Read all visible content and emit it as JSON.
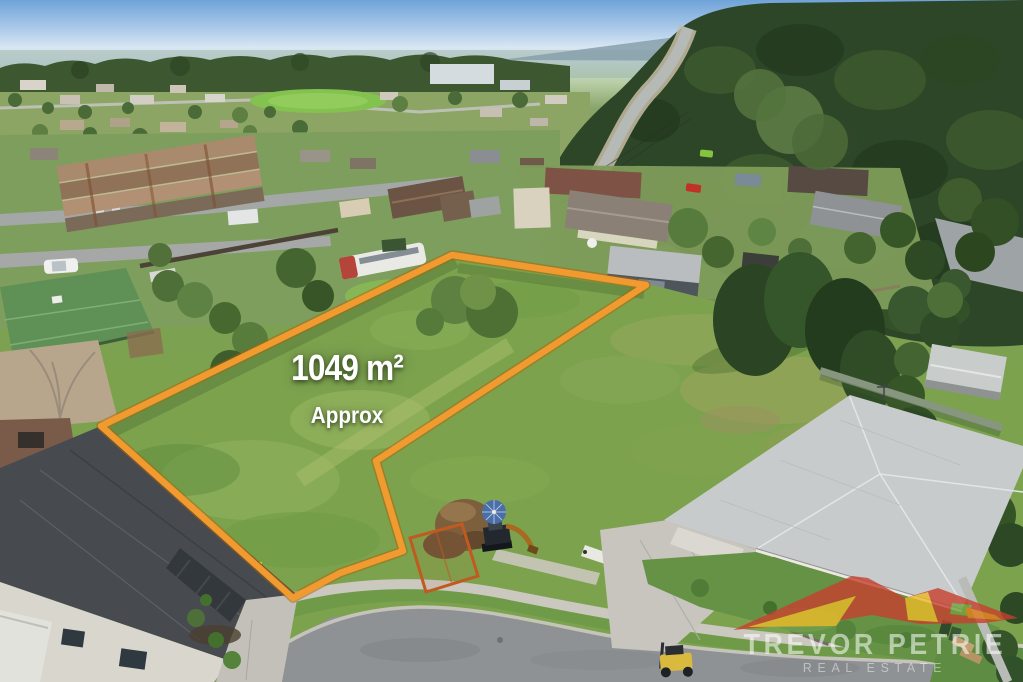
{
  "overlay": {
    "area_value": "1049 m²",
    "area_qualifier": "Approx",
    "text_color": "#FFFFFF"
  },
  "watermark": {
    "brand": "TREVOR PETRIE",
    "tagline": "REAL ESTATE",
    "brand_color": "rgba(255,255,255,0.55)",
    "tagline_color": "rgba(255,255,255,0.45)"
  },
  "boundary": {
    "color": "#F09A2F",
    "shadow_color": "#A96208",
    "points": "101,426 452,255 646,285 376,461 403,551 340,573 293,598"
  },
  "logo_colors": {
    "red": "#C7402F",
    "yellow": "#ECBA27",
    "orange": "#E27C17",
    "green": "#70A23E"
  }
}
